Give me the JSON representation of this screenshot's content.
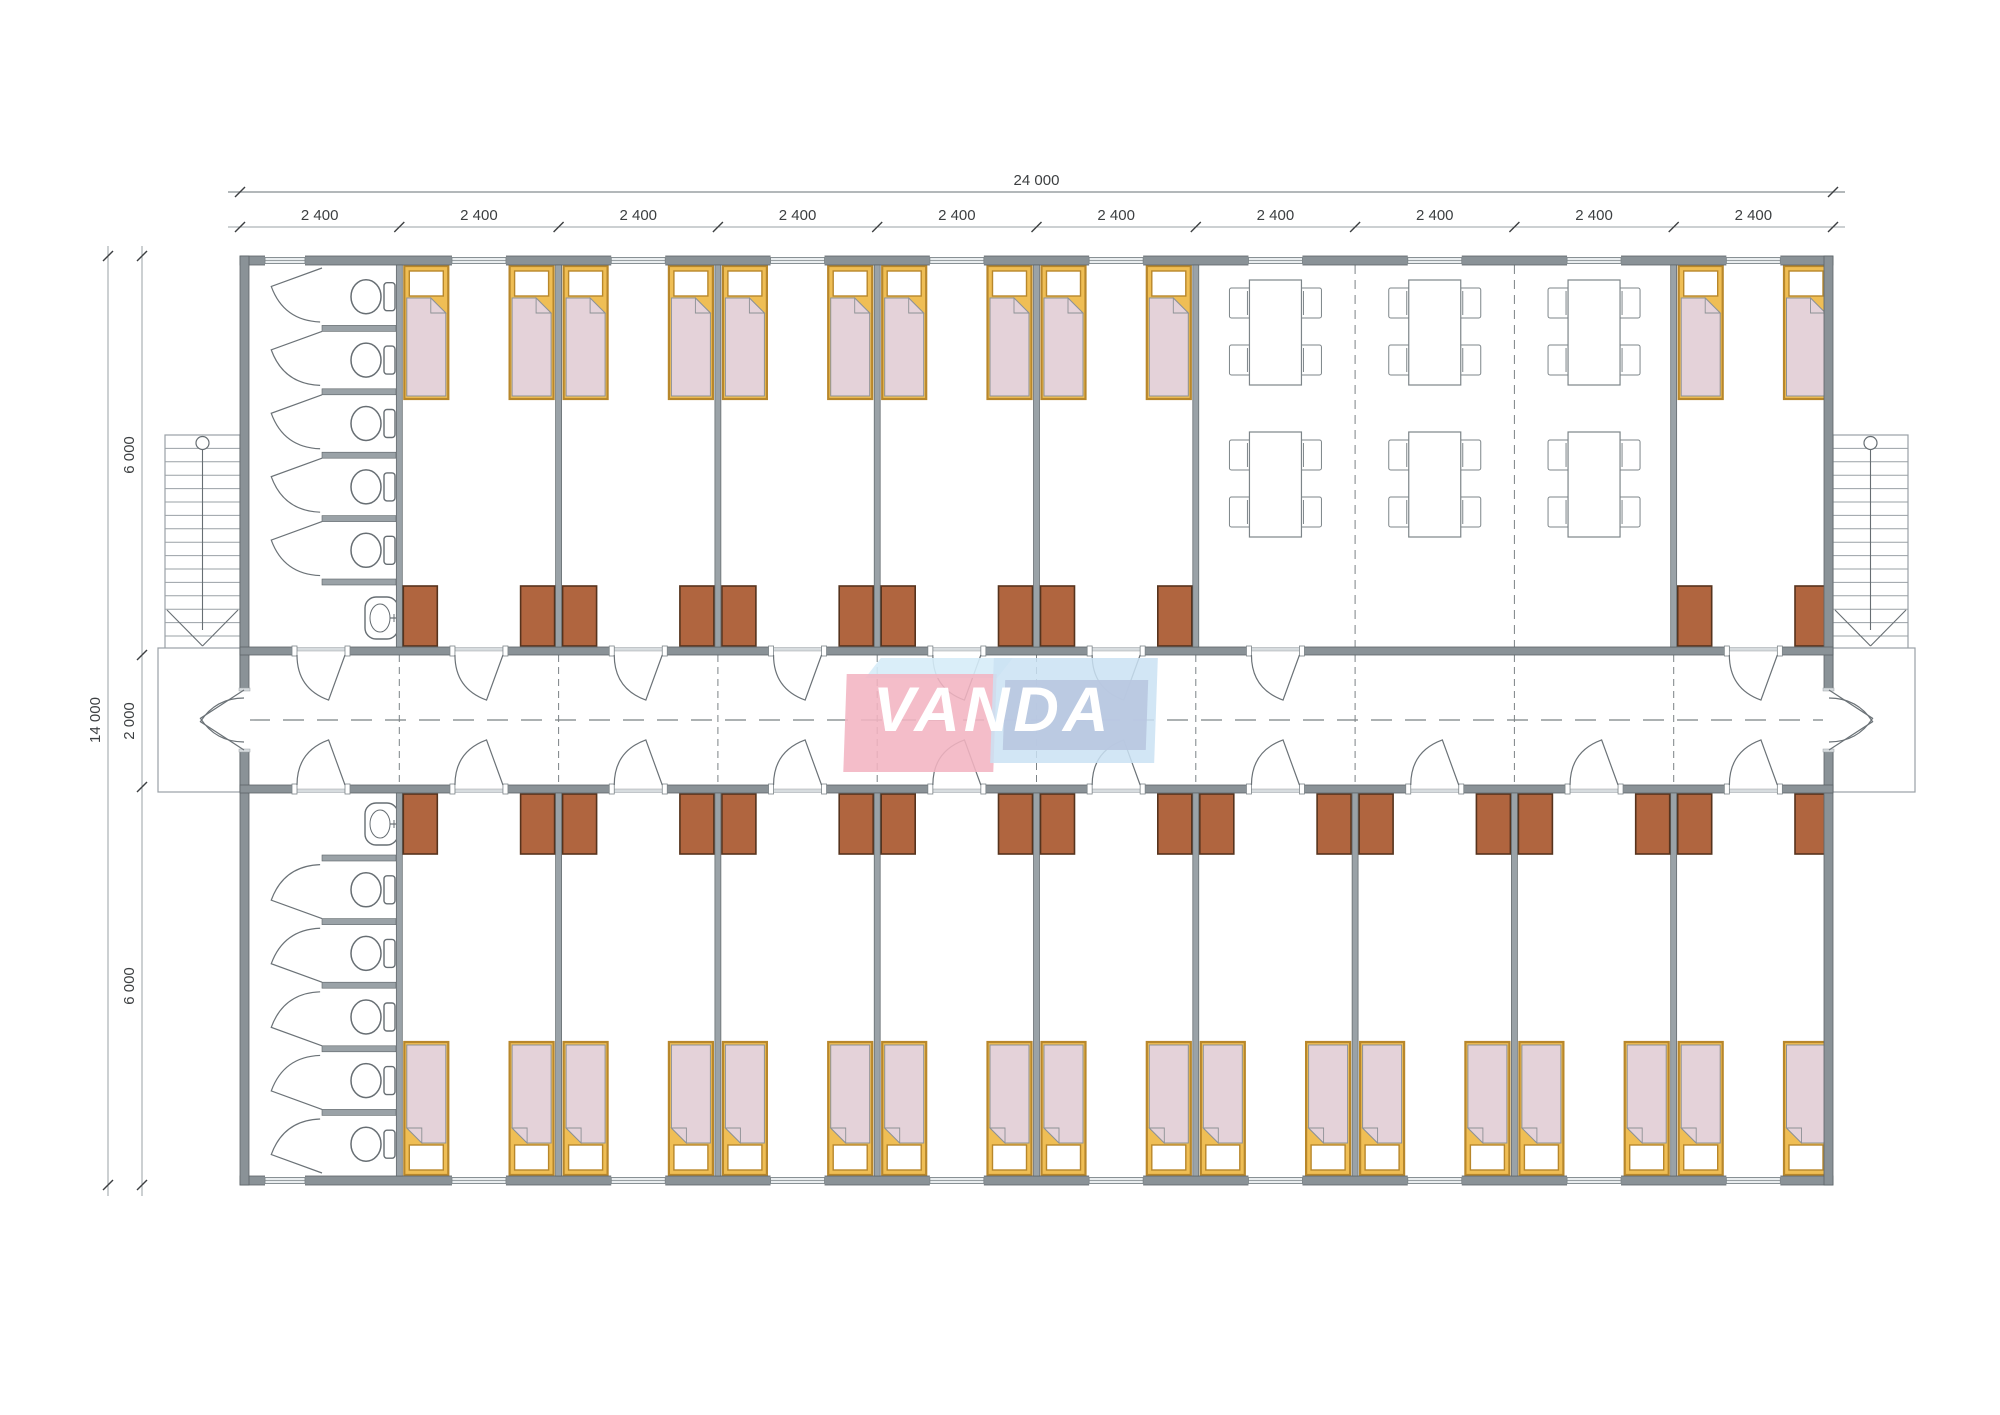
{
  "sheet": {
    "background": "#ffffff"
  },
  "dimensions": {
    "top_total_label": "24 000",
    "top_bay_label": "2 400",
    "top_bay_count": 10,
    "left_total_label": "14 000",
    "left_segment_labels": [
      "6 000",
      "2 000",
      "6 000"
    ]
  },
  "logo": {
    "text": "VANDA",
    "left_part": "VAN",
    "right_part": "DA",
    "pink_color": "rgba(243,180,194,0.88)",
    "blue_color": "rgba(202,226,243,0.85)",
    "panel_color": "rgba(184,199,224,0.9)",
    "top_face_color": "rgba(214,236,248,0.9)",
    "text_color": "#ffffff"
  },
  "layout": {
    "rows": {
      "top": {
        "bathroom_bay": 1,
        "bedroom_bays": [
          2,
          3,
          4,
          5,
          6,
          10
        ],
        "dining_bays": [
          7,
          8,
          9
        ]
      },
      "bottom": {
        "bathroom_bay": 1,
        "bedroom_bays": [
          2,
          3,
          4,
          5,
          6,
          7,
          8,
          9,
          10
        ]
      }
    },
    "room_contents": {
      "bedroom": {
        "beds": 2,
        "wardrobes": 2,
        "doors": 1,
        "windows": 1
      },
      "bathroom": {
        "toilet_stalls": 5,
        "sinks": 1,
        "doors": 1,
        "windows": 1
      },
      "dining": {
        "tables": 6,
        "chairs_per_table": 4,
        "table_rows": 2,
        "modules": 3,
        "doors": 1,
        "windows": 3
      }
    },
    "stairs": {
      "count": 2,
      "locations": [
        "left",
        "right"
      ],
      "treads": 15
    },
    "corridor": {
      "entrance_doors": 2
    }
  },
  "colors": {
    "wall": "#8a9297",
    "wall_outline": "#5c6367",
    "partition": "#9aa2a7",
    "bed_frame": "#efbe55",
    "bed_frame_border": "#b8872b",
    "bed_blanket": "#e4d2d9",
    "bed_blanket_outline": "#8d9195",
    "wardrobe": "#b0653f",
    "wardrobe_border": "#56331d",
    "fixture_outline": "#676e73",
    "furniture_outline": "#7d8589",
    "stair_outline": "#9aa1a6",
    "dash_line": "#7b8285",
    "dim_line": "#9aa0a4",
    "dim_text": "#3c3f41",
    "window_fill": "#e9edef",
    "sill": "#d7dcdf",
    "door_line": "#6b7277"
  }
}
